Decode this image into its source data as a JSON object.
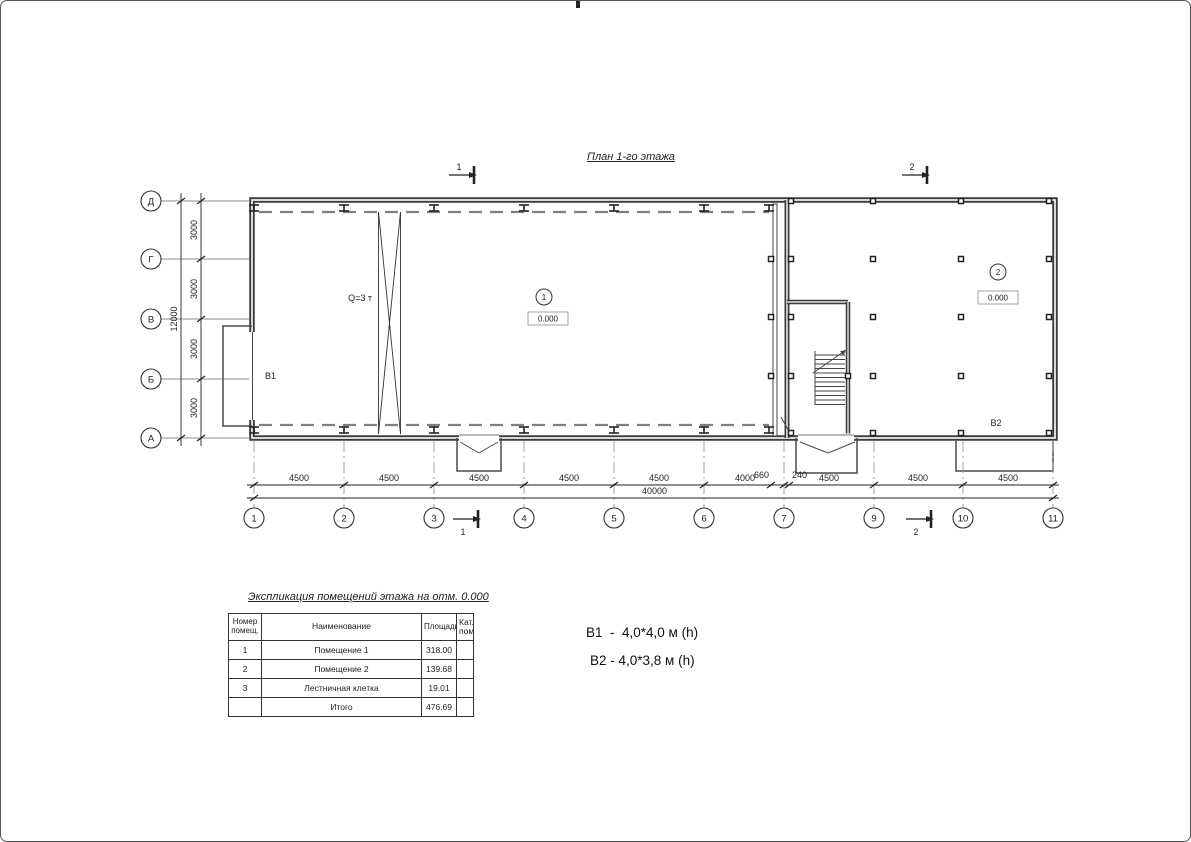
{
  "page": {
    "title": "План 1-го этажа"
  },
  "plan": {
    "crane_label": "Q=3 т",
    "rooms": {
      "room1_number": "1",
      "room1_elevation": "0.000",
      "room1_door": "B1",
      "room2_number": "2",
      "room2_elevation": "0.000",
      "room2_door": "B2"
    },
    "axes_left": [
      "Д",
      "Г",
      "В",
      "Б",
      "А"
    ],
    "axes_bottom": [
      "1",
      "2",
      "3",
      "4",
      "5",
      "6",
      "7",
      "9",
      "10",
      "11"
    ],
    "dims_left": [
      "3000",
      "3000",
      "3000",
      "3000"
    ],
    "dims_left_total": "12000",
    "dims_bottom": [
      "4500",
      "4500",
      "4500",
      "4500",
      "4500",
      "4000",
      "660",
      "240",
      "4500",
      "4500",
      "4500"
    ],
    "dims_bottom_total": "40000",
    "sections": {
      "s1": "1",
      "s2": "2"
    }
  },
  "table": {
    "title": "Экспликация помещений этажа на отм. 0.000",
    "headers": {
      "num": "Номер помещ.",
      "name": "Наименование",
      "area": "Площадь",
      "cat": "Кат. пом."
    },
    "rows": [
      {
        "num": "1",
        "name": "Помещение 1",
        "area": "318.00",
        "cat": ""
      },
      {
        "num": "2",
        "name": "Помещение 2",
        "area": "139.68",
        "cat": ""
      },
      {
        "num": "3",
        "name": "Лестничная клетка",
        "area": "19.01",
        "cat": ""
      }
    ],
    "total_label": "Итого",
    "total_value": "476.69"
  },
  "notes": {
    "b1": "B1  -  4,0*4,0 м (h)",
    "b2": "B2 - 4,0*3,8 м (h)"
  }
}
